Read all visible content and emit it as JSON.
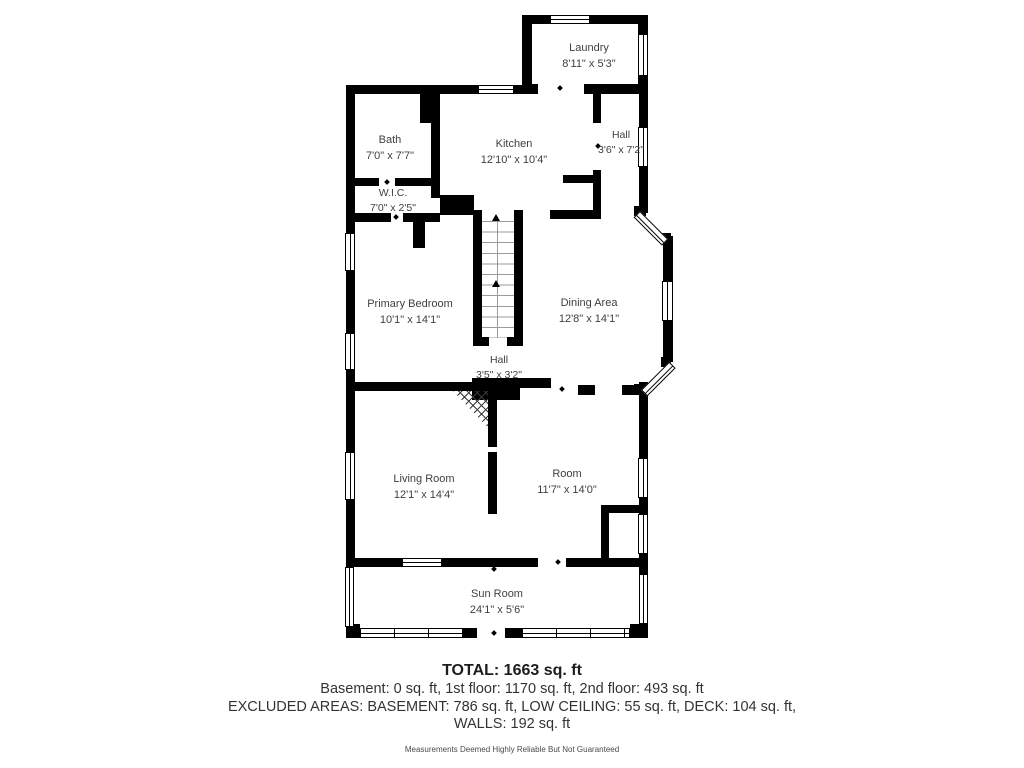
{
  "plan": {
    "rooms": {
      "laundry": {
        "name": "Laundry",
        "dims": "8'11\" x 5'3\""
      },
      "bath": {
        "name": "Bath",
        "dims": "7'0\" x 7'7\""
      },
      "kitchen": {
        "name": "Kitchen",
        "dims": "12'10\" x 10'4\""
      },
      "hall_top": {
        "name": "Hall",
        "dims": "3'6\" x 7'2\""
      },
      "wic": {
        "name": "W.I.C.",
        "dims": "7'0\" x 2'5\""
      },
      "primary": {
        "name": "Primary Bedroom",
        "dims": "10'1\" x 14'1\""
      },
      "dining": {
        "name": "Dining Area",
        "dims": "12'8\" x 14'1\""
      },
      "hall_mid": {
        "name": "Hall",
        "dims": "3'5\" x 3'2\""
      },
      "living": {
        "name": "Living Room",
        "dims": "12'1\" x 14'4\""
      },
      "room": {
        "name": "Room",
        "dims": "11'7\" x 14'0\""
      },
      "sunroom": {
        "name": "Sun Room",
        "dims": "24'1\" x 5'6\""
      }
    }
  },
  "summary": {
    "total": "TOTAL: 1663 sq. ft",
    "floors": "Basement: 0 sq. ft, 1st floor: 1170 sq. ft, 2nd floor: 493 sq. ft",
    "excluded": "EXCLUDED AREAS: BASEMENT: 786 sq. ft, LOW CEILING: 55 sq. ft, DECK: 104 sq. ft,",
    "walls": "WALLS: 192 sq. ft",
    "disclaimer": "Measurements Deemed Highly Reliable But Not Guaranteed"
  },
  "colors": {
    "wall": "#000000",
    "label": "#3f3f3f",
    "summary": "#333333",
    "tread": "#9b9b9b"
  }
}
